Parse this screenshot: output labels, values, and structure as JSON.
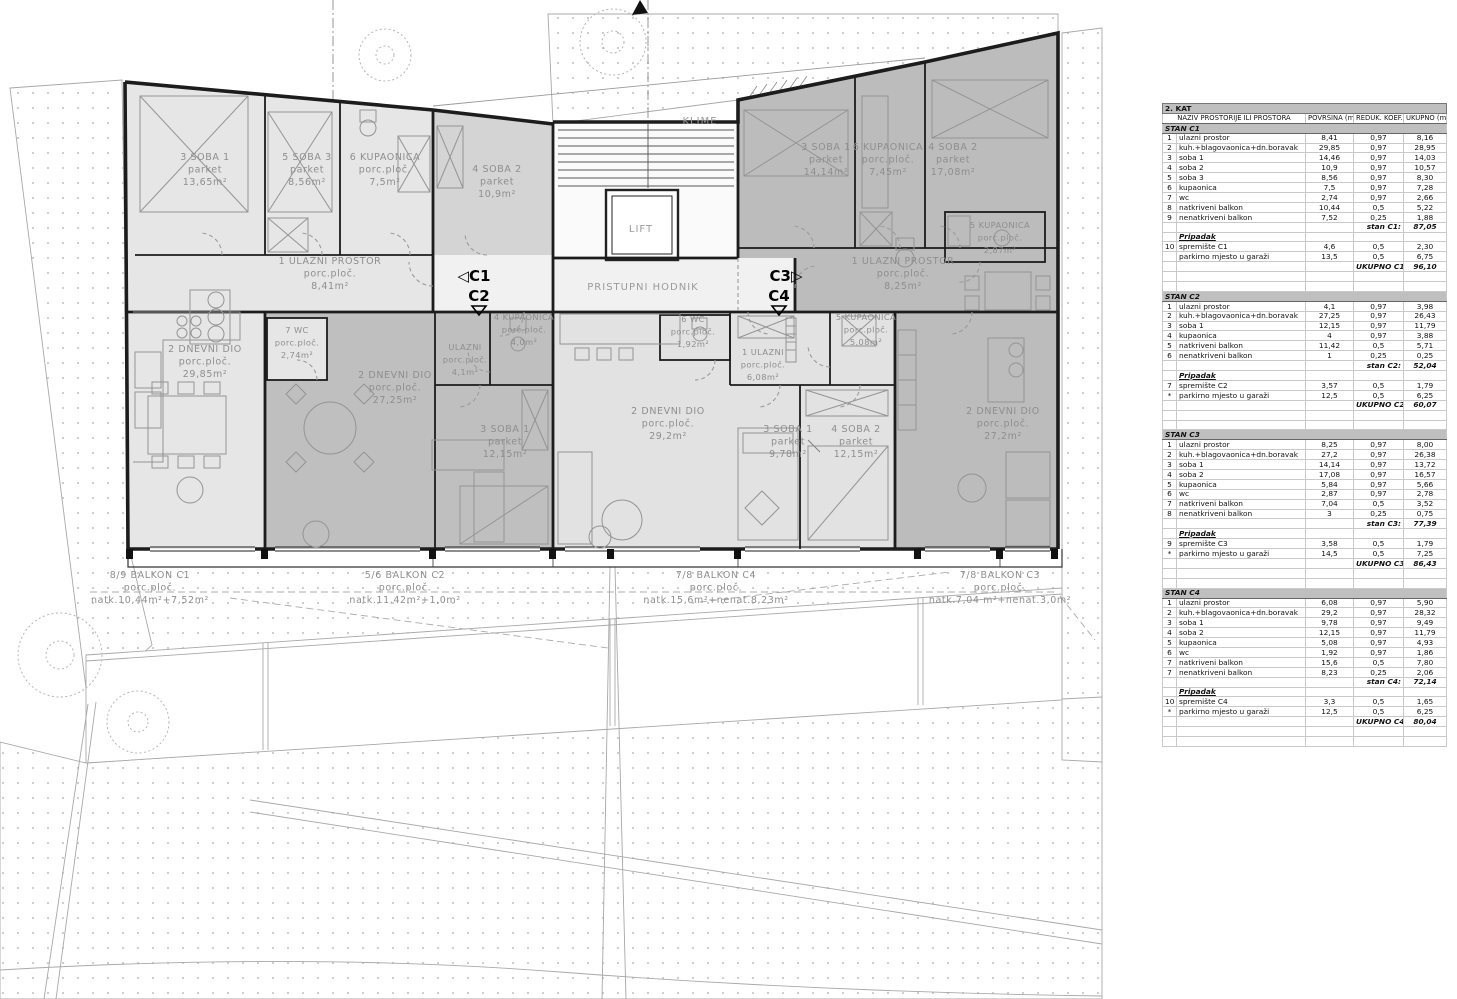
{
  "floor_title": "2. KAT",
  "table": {
    "columns": [
      "NAZIV PROSTORIJE ILI PROSTORA",
      "POVRŠINA (m2)",
      "REDUK. KOEF.",
      "UKUPNO (m2)"
    ],
    "sections": [
      {
        "title": "STAN C1",
        "rows": [
          [
            "1",
            "ulazni prostor",
            "8,41",
            "0,97",
            "8,16"
          ],
          [
            "2",
            "kuh.+blagovaonica+dn.boravak",
            "29,85",
            "0,97",
            "28,95"
          ],
          [
            "3",
            "soba 1",
            "14,46",
            "0,97",
            "14,03"
          ],
          [
            "4",
            "soba 2",
            "10,9",
            "0,97",
            "10,57"
          ],
          [
            "5",
            "soba 3",
            "8,56",
            "0,97",
            "8,30"
          ],
          [
            "6",
            "kupaonica",
            "7,5",
            "0,97",
            "7,28"
          ],
          [
            "7",
            "wc",
            "2,74",
            "0,97",
            "2,66"
          ],
          [
            "8",
            "natkriveni balkon",
            "10,44",
            "0,5",
            "5,22"
          ],
          [
            "9",
            "nenatkriveni balkon",
            "7,52",
            "0,25",
            "1,88"
          ]
        ],
        "subtotal_label": "stan C1:",
        "subtotal_value": "87,05",
        "pripadak_label": "Pripadak",
        "pripadak_rows": [
          [
            "10",
            "spremište C1",
            "4,6",
            "0,5",
            "2,30"
          ],
          [
            "",
            "parkirno mjesto u garaži",
            "13,5",
            "0,5",
            "6,75"
          ]
        ],
        "total_label": "UKUPNO C1:",
        "total_value": "96,10"
      },
      {
        "title": "STAN C2",
        "rows": [
          [
            "1",
            "ulazni prostor",
            "4,1",
            "0,97",
            "3,98"
          ],
          [
            "2",
            "kuh.+blagovaonica+dn.boravak",
            "27,25",
            "0,97",
            "26,43"
          ],
          [
            "3",
            "soba 1",
            "12,15",
            "0,97",
            "11,79"
          ],
          [
            "4",
            "kupaonica",
            "4",
            "0,97",
            "3,88"
          ],
          [
            "5",
            "natkriveni balkon",
            "11,42",
            "0,5",
            "5,71"
          ],
          [
            "6",
            "nenatkriveni balkon",
            "1",
            "0,25",
            "0,25"
          ]
        ],
        "subtotal_label": "stan C2:",
        "subtotal_value": "52,04",
        "pripadak_label": "Pripadak",
        "pripadak_rows": [
          [
            "7",
            "spremište C2",
            "3,57",
            "0,5",
            "1,79"
          ],
          [
            "*",
            "parkirno mjesto u garaži",
            "12,5",
            "0,5",
            "6,25"
          ]
        ],
        "total_label": "UKUPNO C2:",
        "total_value": "60,07"
      },
      {
        "title": "STAN C3",
        "rows": [
          [
            "1",
            "ulazni prostor",
            "8,25",
            "0,97",
            "8,00"
          ],
          [
            "2",
            "kuh.+blagovaonica+dn.boravak",
            "27,2",
            "0,97",
            "26,38"
          ],
          [
            "3",
            "soba 1",
            "14,14",
            "0,97",
            "13,72"
          ],
          [
            "4",
            "soba 2",
            "17,08",
            "0,97",
            "16,57"
          ],
          [
            "5",
            "kupaonica",
            "5,84",
            "0,97",
            "5,66"
          ],
          [
            "6",
            "wc",
            "2,87",
            "0,97",
            "2,78"
          ],
          [
            "7",
            "natkriveni balkon",
            "7,04",
            "0,5",
            "3,52"
          ],
          [
            "8",
            "nenatkriveni balkon",
            "3",
            "0,25",
            "0,75"
          ]
        ],
        "subtotal_label": "stan C3:",
        "subtotal_value": "77,39",
        "pripadak_label": "Pripadak",
        "pripadak_rows": [
          [
            "9",
            "spremište C3",
            "3,58",
            "0,5",
            "1,79"
          ],
          [
            "*",
            "parkirno mjesto u garaži",
            "14,5",
            "0,5",
            "7,25"
          ]
        ],
        "total_label": "UKUPNO C3:",
        "total_value": "86,43"
      },
      {
        "title": "STAN C4",
        "rows": [
          [
            "1",
            "ulazni prostor",
            "6,08",
            "0,97",
            "5,90"
          ],
          [
            "2",
            "kuh.+blagovaonica+dn.boravak",
            "29,2",
            "0,97",
            "28,32"
          ],
          [
            "3",
            "soba 1",
            "9,78",
            "0,97",
            "9,49"
          ],
          [
            "4",
            "soba 2",
            "12,15",
            "0,97",
            "11,79"
          ],
          [
            "5",
            "kupaonica",
            "5,08",
            "0,97",
            "4,93"
          ],
          [
            "6",
            "wc",
            "1,92",
            "0,97",
            "1,86"
          ],
          [
            "7",
            "natkriveni balkon",
            "15,6",
            "0,5",
            "7,80"
          ],
          [
            "7",
            "nenatkriveni balkon",
            "8,23",
            "0,25",
            "2,06"
          ]
        ],
        "subtotal_label": "stan C4:",
        "subtotal_value": "72,14",
        "pripadak_label": "Pripadak",
        "pripadak_rows": [
          [
            "10",
            "spremište C4",
            "3,3",
            "0,5",
            "1,65"
          ],
          [
            "*",
            "parkirno mjesto u garaži",
            "12,5",
            "0,5",
            "6,25"
          ]
        ],
        "total_label": "UKUPNO C4:",
        "total_value": "80,04"
      }
    ]
  },
  "plan": {
    "labels": [
      {
        "x": 205,
        "y": 160,
        "cls": "roomlbl",
        "lines": [
          "3 SOBA 1",
          "parket",
          "13,65m²"
        ]
      },
      {
        "x": 307,
        "y": 160,
        "cls": "roomlbl",
        "lines": [
          "5 SOBA 3",
          "parket",
          "8,56m²"
        ]
      },
      {
        "x": 385,
        "y": 160,
        "cls": "roomlbl",
        "lines": [
          "6 KUPAONICA",
          "porc.ploč.",
          "7,5m²"
        ]
      },
      {
        "x": 497,
        "y": 172,
        "cls": "roomlbl",
        "lines": [
          "4 SOBA 2",
          "parket",
          "10,9m²"
        ]
      },
      {
        "x": 330,
        "y": 264,
        "cls": "roomlbl",
        "lines": [
          "1 ULAZNI PROSTOR",
          "porc.ploč.",
          "8,41m²"
        ]
      },
      {
        "x": 205,
        "y": 352,
        "cls": "roomlbl",
        "lines": [
          "2 DNEVNI DIO",
          "porc.ploč.",
          "29,85m²"
        ]
      },
      {
        "x": 297,
        "y": 333,
        "cls": "roomsm",
        "lines": [
          "7 WC",
          "porc.ploč.",
          "2,74m²"
        ]
      },
      {
        "x": 395,
        "y": 378,
        "cls": "roomlbl",
        "lines": [
          "2 DNEVNI DIO",
          "porc.ploč.",
          "27,25m²"
        ]
      },
      {
        "x": 465,
        "y": 350,
        "cls": "roomsm",
        "lines": [
          "ULAZNI",
          "porc.ploč.",
          "4,1m²"
        ]
      },
      {
        "x": 524,
        "y": 320,
        "cls": "roomsm",
        "lines": [
          "4 KUPAONICA",
          "porc.ploč.",
          "4,0m²"
        ]
      },
      {
        "x": 505,
        "y": 432,
        "cls": "roomlbl",
        "lines": [
          "3 SOBA 1",
          "parket",
          "12,15m²"
        ]
      },
      {
        "x": 693,
        "y": 322,
        "cls": "roomsm",
        "lines": [
          "6 WC",
          "porc.ploč.",
          "1,92m²"
        ]
      },
      {
        "x": 763,
        "y": 355,
        "cls": "roomsm",
        "lines": [
          "1 ULAZNI",
          "porc.ploč.",
          "6,08m²"
        ]
      },
      {
        "x": 866,
        "y": 320,
        "cls": "roomsm",
        "lines": [
          "5 KUPAONICA",
          "porc.ploč.",
          "5,08m²"
        ]
      },
      {
        "x": 668,
        "y": 414,
        "cls": "roomlbl",
        "lines": [
          "2 DNEVNI DIO",
          "porc.ploč.",
          "29,2m²"
        ]
      },
      {
        "x": 788,
        "y": 432,
        "cls": "roomlbl",
        "lines": [
          "3 SOBA 1",
          "parket",
          "9,78m²"
        ]
      },
      {
        "x": 856,
        "y": 432,
        "cls": "roomlbl",
        "lines": [
          "4 SOBA 2",
          "parket",
          "12,15m²"
        ]
      },
      {
        "x": 826,
        "y": 150,
        "cls": "roomlbl",
        "lines": [
          "3 SOBA 1",
          "parket",
          "14,14m²"
        ]
      },
      {
        "x": 888,
        "y": 150,
        "cls": "roomlbl",
        "lines": [
          "6 KUPAONICA",
          "porc.ploč.",
          "7,45m²"
        ]
      },
      {
        "x": 953,
        "y": 150,
        "cls": "roomlbl",
        "lines": [
          "4 SOBA 2",
          "parket",
          "17,08m²"
        ]
      },
      {
        "x": 1000,
        "y": 228,
        "cls": "roomsm",
        "lines": [
          "5 KUPAONICA",
          "porc.ploč.",
          "2,87m²"
        ]
      },
      {
        "x": 903,
        "y": 264,
        "cls": "roomlbl",
        "lines": [
          "1 ULAZNI PROSTOR",
          "porc.ploč.",
          "8,25m²"
        ]
      },
      {
        "x": 1003,
        "y": 414,
        "cls": "roomlbl",
        "lines": [
          "2 DNEVNI DIO",
          "porc.ploč.",
          "27,2m²"
        ]
      },
      {
        "x": 700,
        "y": 124,
        "cls": "corrlbl",
        "lines": [
          "KLIME"
        ]
      },
      {
        "x": 641,
        "y": 232,
        "cls": "corrlbl",
        "lines": [
          "LIFT"
        ]
      },
      {
        "x": 643,
        "y": 290,
        "cls": "corrlbl",
        "lines": [
          "PRISTUPNI HODNIK"
        ]
      },
      {
        "x": 150,
        "y": 578,
        "cls": "balklbl",
        "lines": [
          "8/9 BALKON C1",
          "porc.ploč.",
          "natk.10,44m²+7,52m²"
        ]
      },
      {
        "x": 405,
        "y": 578,
        "cls": "balklbl",
        "lines": [
          "5/6 BALKON C2",
          "porc.ploč.",
          "natk.11,42m²+1,0m²"
        ]
      },
      {
        "x": 716,
        "y": 578,
        "cls": "balklbl",
        "lines": [
          "7/8 BALKON C4",
          "porc.ploč.",
          "natk.15,6m²+nenat.8,23m²"
        ]
      },
      {
        "x": 1000,
        "y": 578,
        "cls": "balklbl",
        "lines": [
          "7/8 BALKON C3",
          "porc.ploč.",
          "natk.7,04 m²+nenat.3,0m²"
        ]
      },
      {
        "x": 474,
        "y": 281,
        "cls": "marker",
        "lines": [
          "◁C1"
        ]
      },
      {
        "x": 479,
        "y": 301,
        "cls": "marker",
        "lines": [
          "C2"
        ]
      },
      {
        "x": 786,
        "y": 281,
        "cls": "marker",
        "lines": [
          "C3▷"
        ]
      },
      {
        "x": 779,
        "y": 301,
        "cls": "marker",
        "lines": [
          "C4"
        ]
      }
    ]
  }
}
